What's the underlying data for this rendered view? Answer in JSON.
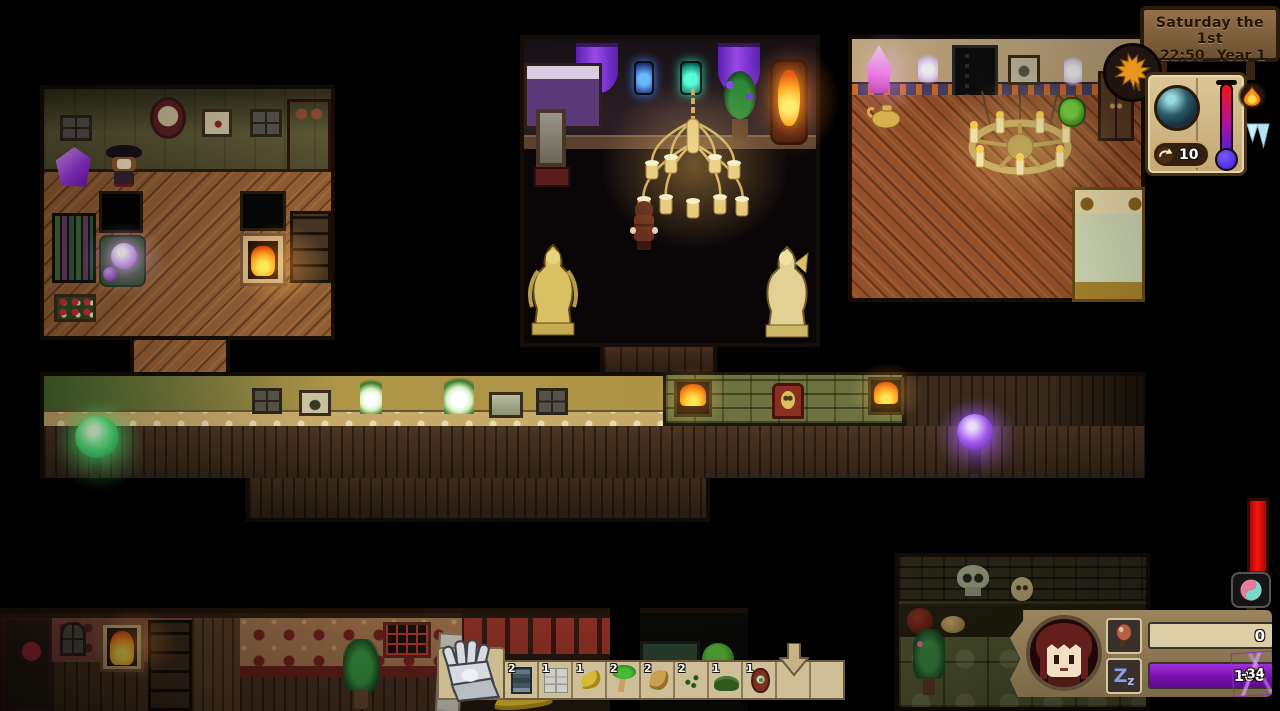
{
  "hud": {
    "date_sign": {
      "day_line": "Saturday the 1st",
      "time": "22:50",
      "year": "Year 1"
    },
    "season_icon": "autumn-maple-leaf",
    "calendar_book": {
      "night_scene_icon": "moonlit-town",
      "actions_counter": "10",
      "counter_icon": "undo-arrow",
      "hot_icon": "flame",
      "cold_icon": "icicles",
      "thermometer_icon": "temperature-gauge"
    },
    "health_bar": {
      "icon": "spirit-swirl"
    },
    "player_panel": {
      "portrait_icon": "player-face",
      "stamina_row": {
        "icon": "balloon",
        "value": "0"
      },
      "sleep_row": {
        "icon": "sleep-zz",
        "value": "100",
        "badge": "-34",
        "zz_big": "Z",
        "zz_small": "z"
      }
    },
    "hotbar": {
      "tool_icon": "gauntlet",
      "drop_arrow_icon": "down-arrow",
      "slots": [
        {
          "count": "2",
          "item": "furnace"
        },
        {
          "count": "1",
          "item": "blueprint"
        },
        {
          "count": "1",
          "item": "yellow-sprout"
        },
        {
          "count": "2",
          "item": "palm-sapling"
        },
        {
          "count": "2",
          "item": "dry-sprout"
        },
        {
          "count": "2",
          "item": "green-bush"
        },
        {
          "count": "1",
          "item": "dark-bush"
        },
        {
          "count": "1",
          "item": "seed-totem"
        },
        {
          "count": "",
          "item": "empty"
        },
        {
          "count": "",
          "item": "empty"
        }
      ]
    },
    "colors": {
      "sleep_bar": "#8a17b8",
      "health_bar": "#e20808",
      "hotbar_bg": "#cfbf99",
      "parchment": "#d9c294"
    }
  }
}
